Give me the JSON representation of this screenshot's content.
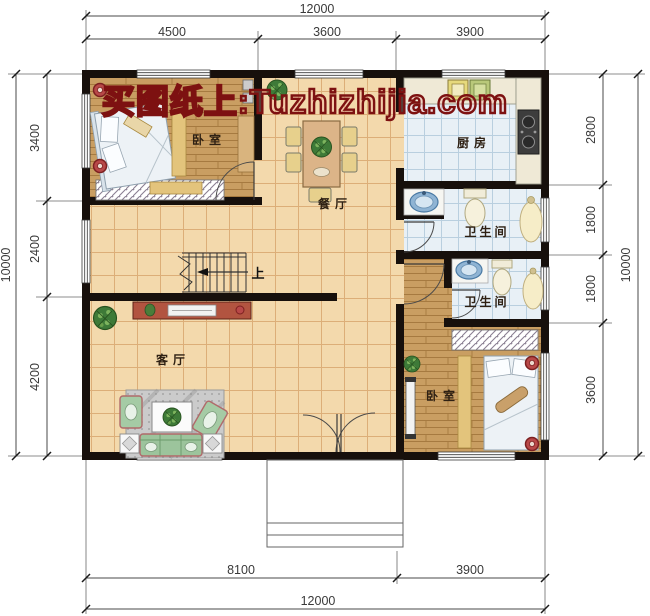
{
  "watermark": {
    "text": "买图纸上:Tuzhizhijia.com",
    "color": "#7d1111"
  },
  "plan": {
    "rooms": [
      {
        "id": "bedroom-top",
        "label": "卧室"
      },
      {
        "id": "dining",
        "label": "餐厅"
      },
      {
        "id": "kitchen",
        "label": "厨房"
      },
      {
        "id": "bath-upper",
        "label": "卫生间"
      },
      {
        "id": "bath-lower",
        "label": "卫生间"
      },
      {
        "id": "living",
        "label": "客厅"
      },
      {
        "id": "bedroom-bottom",
        "label": "卧室"
      }
    ],
    "stairs_label": "上"
  },
  "dimensions": {
    "top": {
      "total": "12000",
      "segments": [
        "4500",
        "3600",
        "3900"
      ]
    },
    "bottom": {
      "total": "12000",
      "segments": [
        "8100",
        "3900"
      ]
    },
    "left": {
      "total": "10000",
      "segments": [
        "3400",
        "2400",
        "4200"
      ]
    },
    "right": {
      "total": "10000",
      "segments": [
        "2800",
        "1800",
        "1800",
        "3600"
      ]
    }
  },
  "colors": {
    "wall": "#17100c",
    "tile_floor": "#f3d9ac",
    "wood_floor": "#c99e62",
    "wet_floor": "#e8f0f6",
    "watermark_red": "#7d1111",
    "sofa_green": "#9cc49c",
    "counter_cream": "#efe9d6",
    "fixture_blue": "#8fb4d4"
  }
}
